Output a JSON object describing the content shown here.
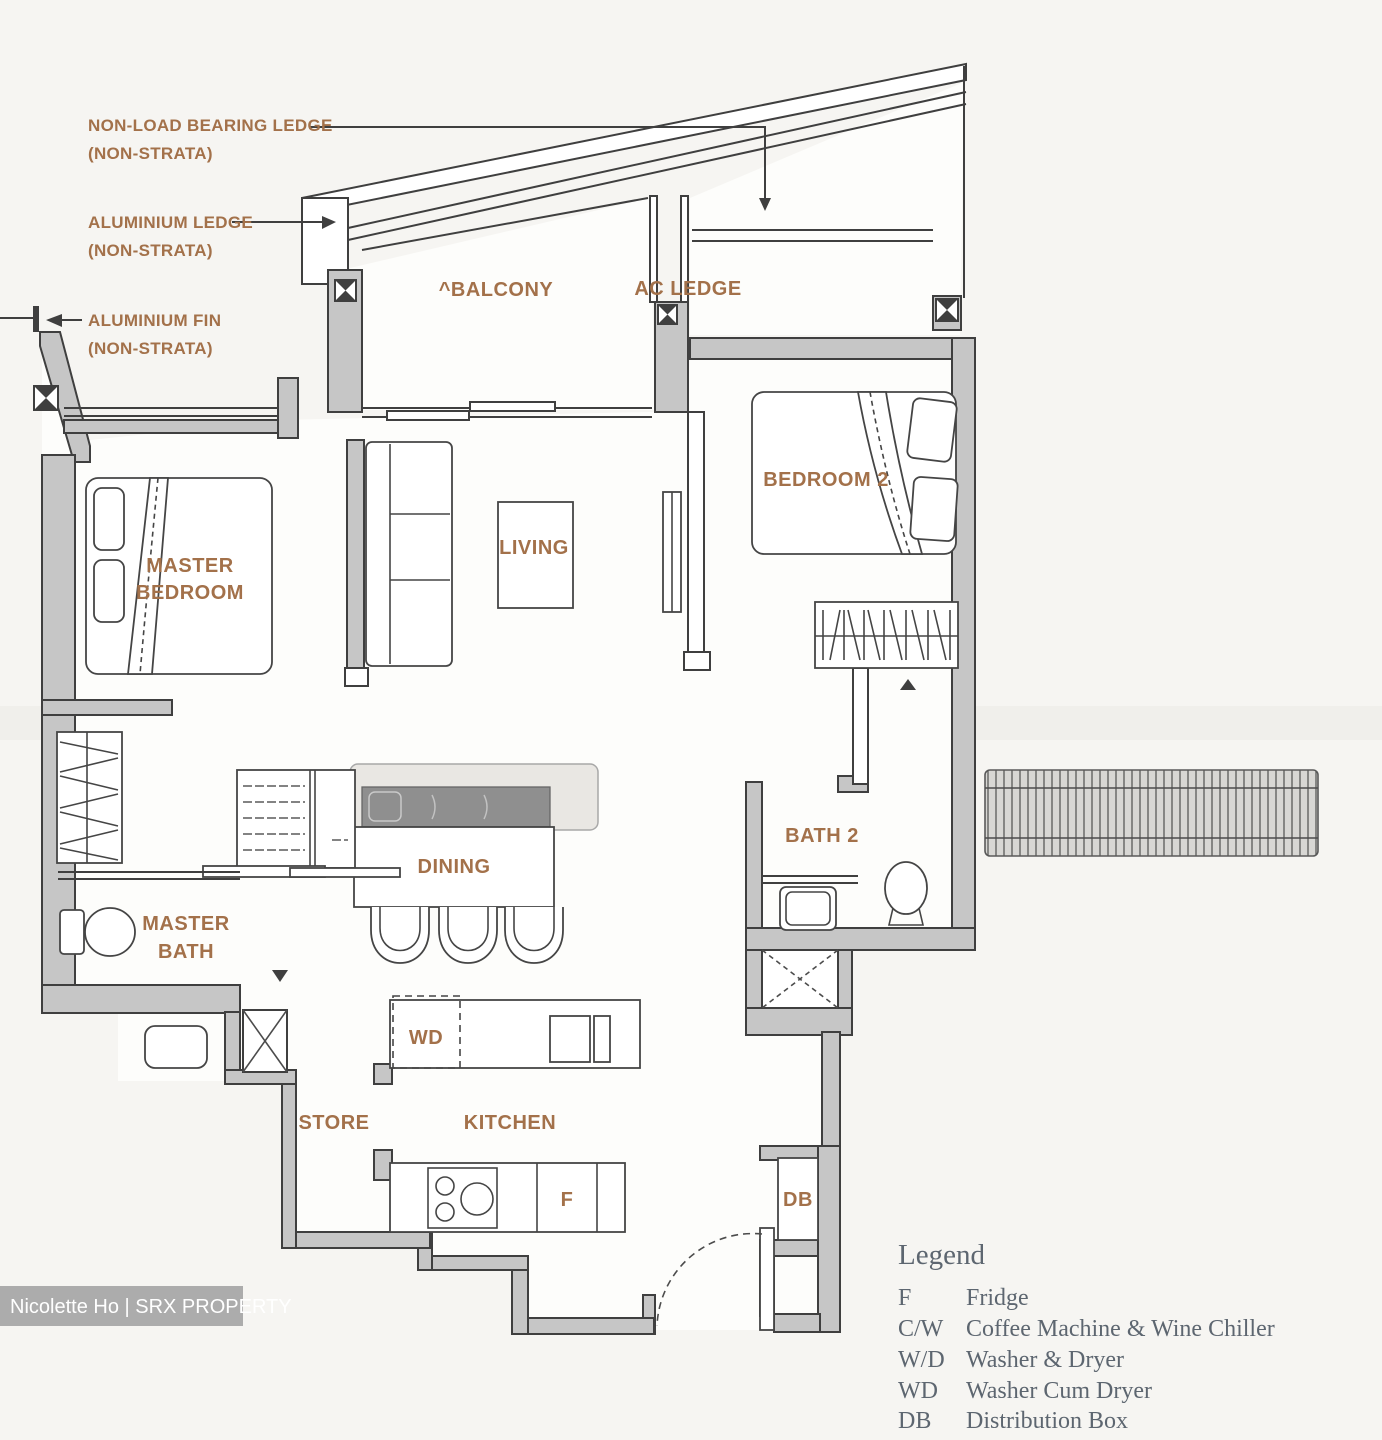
{
  "annotations": {
    "non_load_bearing_ledge": {
      "line1": "NON-LOAD BEARING LEDGE",
      "line2": "(NON-STRATA)"
    },
    "aluminium_ledge": {
      "line1": "ALUMINIUM LEDGE",
      "line2": "(NON-STRATA)"
    },
    "aluminium_fin": {
      "line1": "ALUMINIUM FIN",
      "line2": "(NON-STRATA)"
    }
  },
  "rooms": {
    "balcony": "^BALCONY",
    "ac_ledge": "AC LEDGE",
    "bedroom2": "BEDROOM 2",
    "master_bedroom_line1": "MASTER",
    "master_bedroom_line2": "BEDROOM",
    "living": "LIVING",
    "dining": "DINING",
    "master_bath_line1": "MASTER",
    "master_bath_line2": "BATH",
    "bath2": "BATH 2",
    "store": "STORE",
    "kitchen": "KITCHEN"
  },
  "markers": {
    "wd": "WD",
    "fridge": "F",
    "db": "DB"
  },
  "legend": {
    "title": "Legend",
    "items": [
      {
        "abbr": "F",
        "label": "Fridge"
      },
      {
        "abbr": "C/W",
        "label": "Coffee Machine & Wine Chiller"
      },
      {
        "abbr": "W/D",
        "label": "Washer & Dryer"
      },
      {
        "abbr": "WD",
        "label": "Washer Cum Dryer"
      },
      {
        "abbr": "DB",
        "label": "Distribution Box"
      }
    ]
  },
  "watermark": "Nicolette Ho | SRX PROPERTY",
  "colors": {
    "bg": "#f6f5f2",
    "label": "#a3714a",
    "wall": "#c6c6c6",
    "outline": "#3f3f3f",
    "legend": "#5d6670",
    "watermark_bg": "#acacac",
    "watermark_text": "#ffffff",
    "counter": "#8f8f8f",
    "island": "#e9e7e3",
    "trellis": "#d8d7d4"
  }
}
